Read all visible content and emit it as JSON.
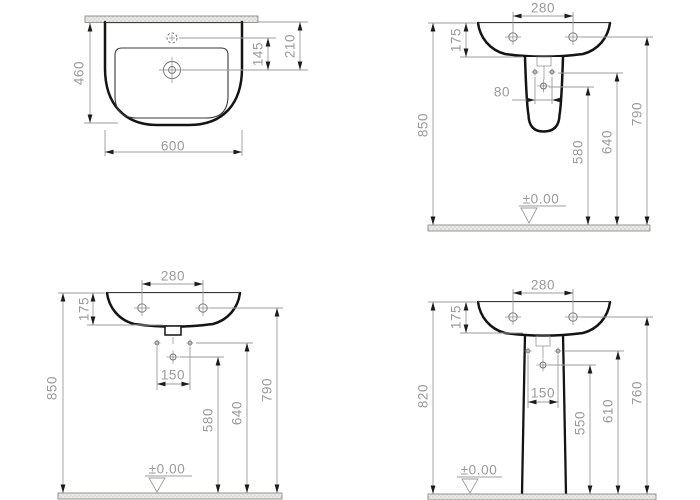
{
  "drawing_type": "washbasin installation dimension drawing",
  "units_note": "mm",
  "views": {
    "plan": {
      "depth": "460",
      "width": "600",
      "tap_to_drain": "145",
      "wall_to_drain": "210"
    },
    "half_pedestal": {
      "hole_spacing": "280",
      "rim_depth": "175",
      "bolt_spacing": "80",
      "drain_height": "580",
      "bolt_height": "640",
      "tap_height": "790",
      "overall_height": "850",
      "floor_level": "±0.00"
    },
    "wall_hung": {
      "hole_spacing": "280",
      "rim_depth": "175",
      "bolt_spacing": "150",
      "drain_height": "580",
      "bolt_height": "640",
      "tap_height": "790",
      "overall_height": "850",
      "floor_level": "±0.00"
    },
    "pedestal": {
      "hole_spacing": "280",
      "rim_depth": "175",
      "bolt_spacing": "150",
      "drain_height": "550",
      "bolt_height": "610",
      "tap_height": "760",
      "overall_height": "820",
      "floor_level": "±0.00"
    }
  },
  "colors": {
    "outline": "#141414",
    "thin": "#3a3a3a",
    "dim-line": "#9c9c9c",
    "dim-text": "#9a9a9a",
    "arrow": "#1c1c1c",
    "surface-edge": "#8c8c8c",
    "surface-fill": "#e9e9e5",
    "hole": "#6e6e6e",
    "background": "#ffffff"
  }
}
